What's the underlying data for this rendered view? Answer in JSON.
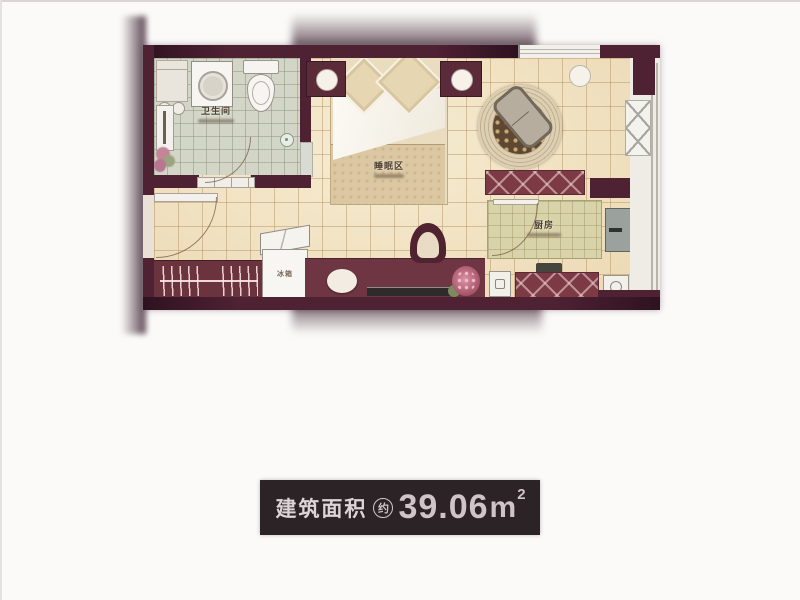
{
  "photo": {
    "rooms": {
      "bathroom": "卫生间",
      "sleeping": "睡眠区",
      "kitchen": "厨房",
      "fridge": "冰箱"
    },
    "area_bar": {
      "prefix": "建筑面积",
      "approx": "约",
      "value": "39.06",
      "unit": "m",
      "sup": "2"
    },
    "colors": {
      "wall": "#4e2133",
      "wall_dark": "#2e1220",
      "floor": "#f6ecd2",
      "bath_tile": "#d3d6c6",
      "counter": "#d9d3a9",
      "cabinet": "#7c3b44",
      "console": "#6e3642",
      "rug_ring": "#dccfb2",
      "rug_center": "#5e4733",
      "balcony": "#efece6",
      "bar_bg": "#2b2326",
      "bar_text": "#ddd4d7"
    }
  }
}
